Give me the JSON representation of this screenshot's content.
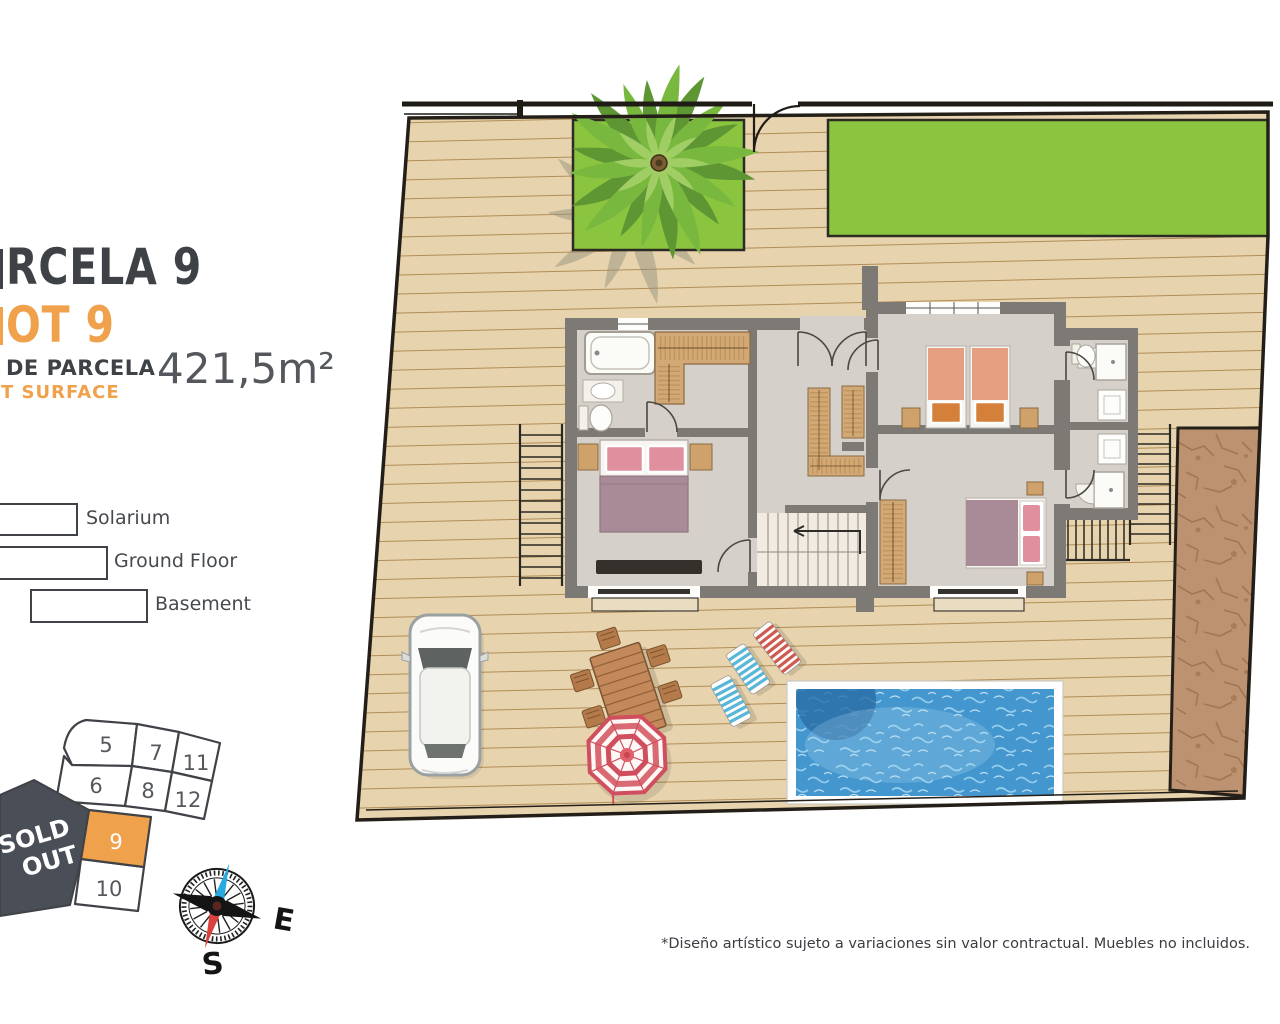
{
  "header": {
    "parcela_title": "RCELA 9",
    "lot_title": "OT 9",
    "surface_label_es": "DE PARCELA",
    "surface_label_en": "T SURFACE",
    "surface_value": "421,5m²"
  },
  "legend": {
    "items": [
      {
        "label": "Solarium"
      },
      {
        "label": "Ground Floor"
      },
      {
        "label": "Basement"
      }
    ]
  },
  "lot_map": {
    "sold_out": {
      "line1": "SOLD",
      "line2": "OUT"
    },
    "highlighted_lot": "9",
    "lots": [
      {
        "label": "5"
      },
      {
        "label": "7"
      },
      {
        "label": "11"
      },
      {
        "label": "6"
      },
      {
        "label": "8"
      },
      {
        "label": "12"
      },
      {
        "label": "9"
      },
      {
        "label": "10"
      }
    ]
  },
  "compass": {
    "east": "E",
    "south": "S"
  },
  "footer": {
    "disclaimer": "*Diseño artístico sujeto a variaciones sin valor contractual. Muebles no incluidos."
  },
  "colors": {
    "accent_orange": "#F0A14C",
    "title_dark": "#3E4247",
    "deck": "#E7D4AE",
    "lawn_green": "#8BC53F",
    "pool_blue": "#4496CE",
    "dirt_brown": "#BC9270",
    "wall_gray": "#7D7A76",
    "sold_out_bg": "#4A4E57"
  }
}
